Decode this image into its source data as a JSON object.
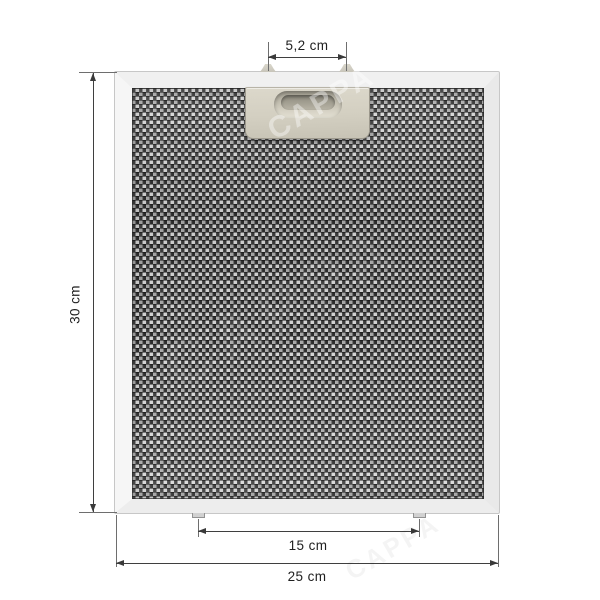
{
  "diagram": {
    "watermark": "CAPPA",
    "dimensions": {
      "top_clip_spacing": "5,2 cm",
      "height": "30 cm",
      "bottom_pin_spacing": "15 cm",
      "width": "25 cm"
    },
    "colors": {
      "background": "#ffffff",
      "dimension_line": "#3f3f3f",
      "frame": "#f0f0f0",
      "mesh_dark": "#2e2e2e",
      "mesh_light": "#d7d7d7",
      "handle": "#d3cfc1"
    }
  }
}
